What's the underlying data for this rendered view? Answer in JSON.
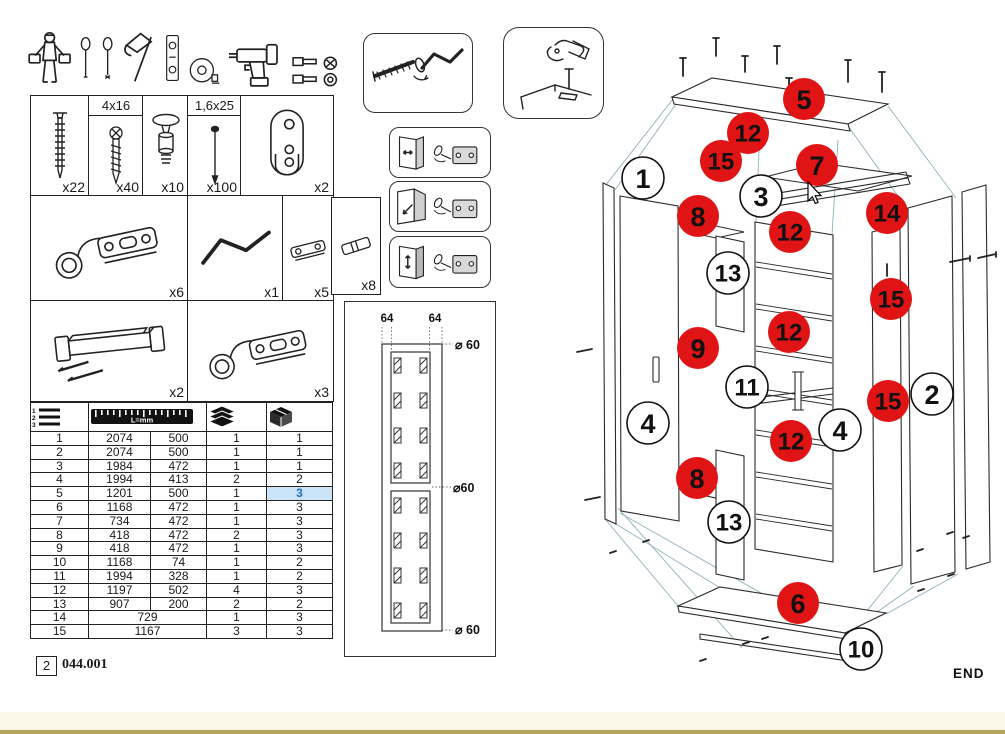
{
  "footer": {
    "page_number": "2",
    "doc_code": "044.001"
  },
  "colors": {
    "callout_red": "#e01414",
    "highlight_text": "#1f6fbe",
    "highlight_bg": "#cce4f7",
    "footer_band": "#fcf8e9",
    "footer_line": "#b4a45c"
  },
  "tools": {
    "icons": [
      "assembler-person",
      "flat-screwdriver",
      "phillips-screwdriver",
      "hammer",
      "spirit-level",
      "tape-measure",
      "cordless-drill",
      "driver-bits"
    ]
  },
  "hardware": {
    "items": [
      {
        "name": "confirmat-screw",
        "qty": "x22"
      },
      {
        "name": "wood-screw",
        "size": "4x16",
        "qty": "x40"
      },
      {
        "name": "cam-stud",
        "qty": "x10"
      },
      {
        "name": "nail",
        "size": "1,6x25",
        "qty": "x100"
      },
      {
        "name": "hanging-rail-bracket",
        "qty": "x2"
      },
      {
        "name": "hinge",
        "qty": "x6"
      },
      {
        "name": "crank-tool",
        "qty": "x1"
      },
      {
        "name": "mounting-plate",
        "qty": "x5"
      },
      {
        "name": "dowel",
        "qty": "x8"
      },
      {
        "name": "handle",
        "qty": "x2"
      },
      {
        "name": "hinge",
        "qty": "x3"
      }
    ]
  },
  "parts_table": {
    "ruler_label": "L=mm",
    "rows": [
      {
        "no": "1",
        "l1": "2074",
        "l2": "500",
        "q1": "1",
        "q2": "1"
      },
      {
        "no": "2",
        "l1": "2074",
        "l2": "500",
        "q1": "1",
        "q2": "1"
      },
      {
        "no": "3",
        "l1": "1984",
        "l2": "472",
        "q1": "1",
        "q2": "1"
      },
      {
        "no": "4",
        "l1": "1994",
        "l2": "413",
        "q1": "2",
        "q2": "2"
      },
      {
        "no": "5",
        "l1": "1201",
        "l2": "500",
        "q1": "1",
        "q2": "3",
        "highlight_q2": true
      },
      {
        "no": "6",
        "l1": "1168",
        "l2": "472",
        "q1": "1",
        "q2": "3"
      },
      {
        "no": "7",
        "l1": "734",
        "l2": "472",
        "q1": "1",
        "q2": "3"
      },
      {
        "no": "8",
        "l1": "418",
        "l2": "472",
        "q1": "2",
        "q2": "3"
      },
      {
        "no": "9",
        "l1": "418",
        "l2": "472",
        "q1": "1",
        "q2": "3"
      },
      {
        "no": "10",
        "l1": "1168",
        "l2": "74",
        "q1": "1",
        "q2": "2"
      },
      {
        "no": "11",
        "l1": "1994",
        "l2": "328",
        "q1": "1",
        "q2": "2"
      },
      {
        "no": "12",
        "l1": "1197",
        "l2": "502",
        "q1": "4",
        "q2": "3"
      },
      {
        "no": "13",
        "l1": "907",
        "l2": "200",
        "q1": "2",
        "q2": "2"
      },
      {
        "no": "14",
        "l1": "729",
        "l2": null,
        "q1": "1",
        "q2": "3"
      },
      {
        "no": "15",
        "l1": "1167",
        "l2": null,
        "q1": "3",
        "q2": "3"
      }
    ]
  },
  "drill_diagram": {
    "dim_top_left": "64",
    "dim_top_right": "64",
    "dia_top": "⌀ 60",
    "dia_mid": "⌀60",
    "dia_bottom": "⌀ 60"
  },
  "exploded_view": {
    "end_label": "END",
    "callouts": [
      {
        "label": "5",
        "type": "red",
        "x": 804,
        "y": 99
      },
      {
        "label": "12",
        "type": "red",
        "x": 748,
        "y": 133
      },
      {
        "label": "15",
        "type": "red",
        "x": 721,
        "y": 161
      },
      {
        "label": "7",
        "type": "red",
        "x": 817,
        "y": 165
      },
      {
        "label": "14",
        "type": "red",
        "x": 887,
        "y": 213
      },
      {
        "label": "8",
        "type": "red",
        "x": 698,
        "y": 216
      },
      {
        "label": "12",
        "type": "red",
        "x": 790,
        "y": 232
      },
      {
        "label": "15",
        "type": "red",
        "x": 891,
        "y": 299
      },
      {
        "label": "12",
        "type": "red",
        "x": 789,
        "y": 332
      },
      {
        "label": "9",
        "type": "red",
        "x": 698,
        "y": 348
      },
      {
        "label": "15",
        "type": "red",
        "x": 888,
        "y": 401
      },
      {
        "label": "12",
        "type": "red",
        "x": 791,
        "y": 441
      },
      {
        "label": "8",
        "type": "red",
        "x": 697,
        "y": 478
      },
      {
        "label": "6",
        "type": "red",
        "x": 798,
        "y": 603
      },
      {
        "label": "1",
        "type": "white",
        "x": 643,
        "y": 178
      },
      {
        "label": "3",
        "type": "white",
        "x": 761,
        "y": 196
      },
      {
        "label": "13",
        "type": "white",
        "x": 728,
        "y": 273
      },
      {
        "label": "11",
        "type": "white",
        "x": 747,
        "y": 387
      },
      {
        "label": "4",
        "type": "white",
        "x": 648,
        "y": 423
      },
      {
        "label": "4",
        "type": "white",
        "x": 840,
        "y": 430
      },
      {
        "label": "2",
        "type": "white",
        "x": 932,
        "y": 394
      },
      {
        "label": "13",
        "type": "white",
        "x": 729,
        "y": 522
      },
      {
        "label": "10",
        "type": "white",
        "x": 861,
        "y": 649
      }
    ]
  }
}
